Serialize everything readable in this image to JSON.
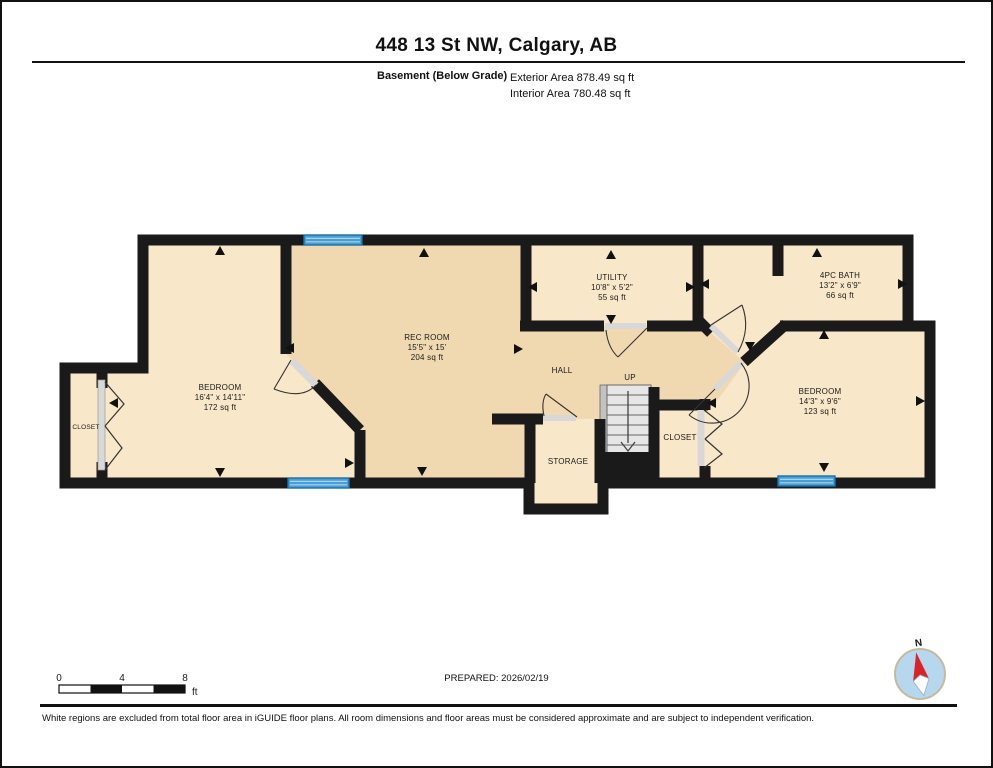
{
  "header": {
    "title": "448 13 St NW, Calgary, AB",
    "floor_label": "Basement (Below Grade)",
    "exterior_area": "Exterior Area 878.49 sq ft",
    "interior_area": "Interior Area 780.48 sq ft"
  },
  "rooms": {
    "bedroom_left": {
      "name": "BEDROOM",
      "dims": "16'4\" x 14'11\"",
      "area": "172 sq ft"
    },
    "rec_room": {
      "name": "REC ROOM",
      "dims": "15'5\" x 15'",
      "area": "204 sq ft"
    },
    "utility": {
      "name": "UTILITY",
      "dims": "10'8\" x 5'2\"",
      "area": "55 sq ft"
    },
    "bath": {
      "name": "4PC BATH",
      "dims": "13'2\" x 6'9\"",
      "area": "66 sq ft"
    },
    "bedroom_right": {
      "name": "BEDROOM",
      "dims": "14'3\" x 9'6\"",
      "area": "123 sq ft"
    },
    "hall": {
      "name": "HALL"
    },
    "stairs": {
      "name": "UP"
    },
    "storage": {
      "name": "STORAGE"
    },
    "closet_left": {
      "name": "CLOSET"
    },
    "closet_right": {
      "name": "CLOSET"
    }
  },
  "scale_bar": {
    "tick0": "0",
    "tick1": "4",
    "tick2": "8",
    "unit": "ft"
  },
  "compass": {
    "north": "N"
  },
  "footer": {
    "prepared": "PREPARED: 2026/02/19",
    "disclaimer": "White regions are excluded from total floor area in iGUIDE floor plans. All room dimensions and floor areas must be considered approximate and are subject to independent verification."
  },
  "colors": {
    "wall": "#1a1a1a",
    "room_light": "#f8e7c8",
    "room_dark": "#f0d9b1",
    "window_blue": "#4a9ed3",
    "compass_red": "#d8232a"
  }
}
